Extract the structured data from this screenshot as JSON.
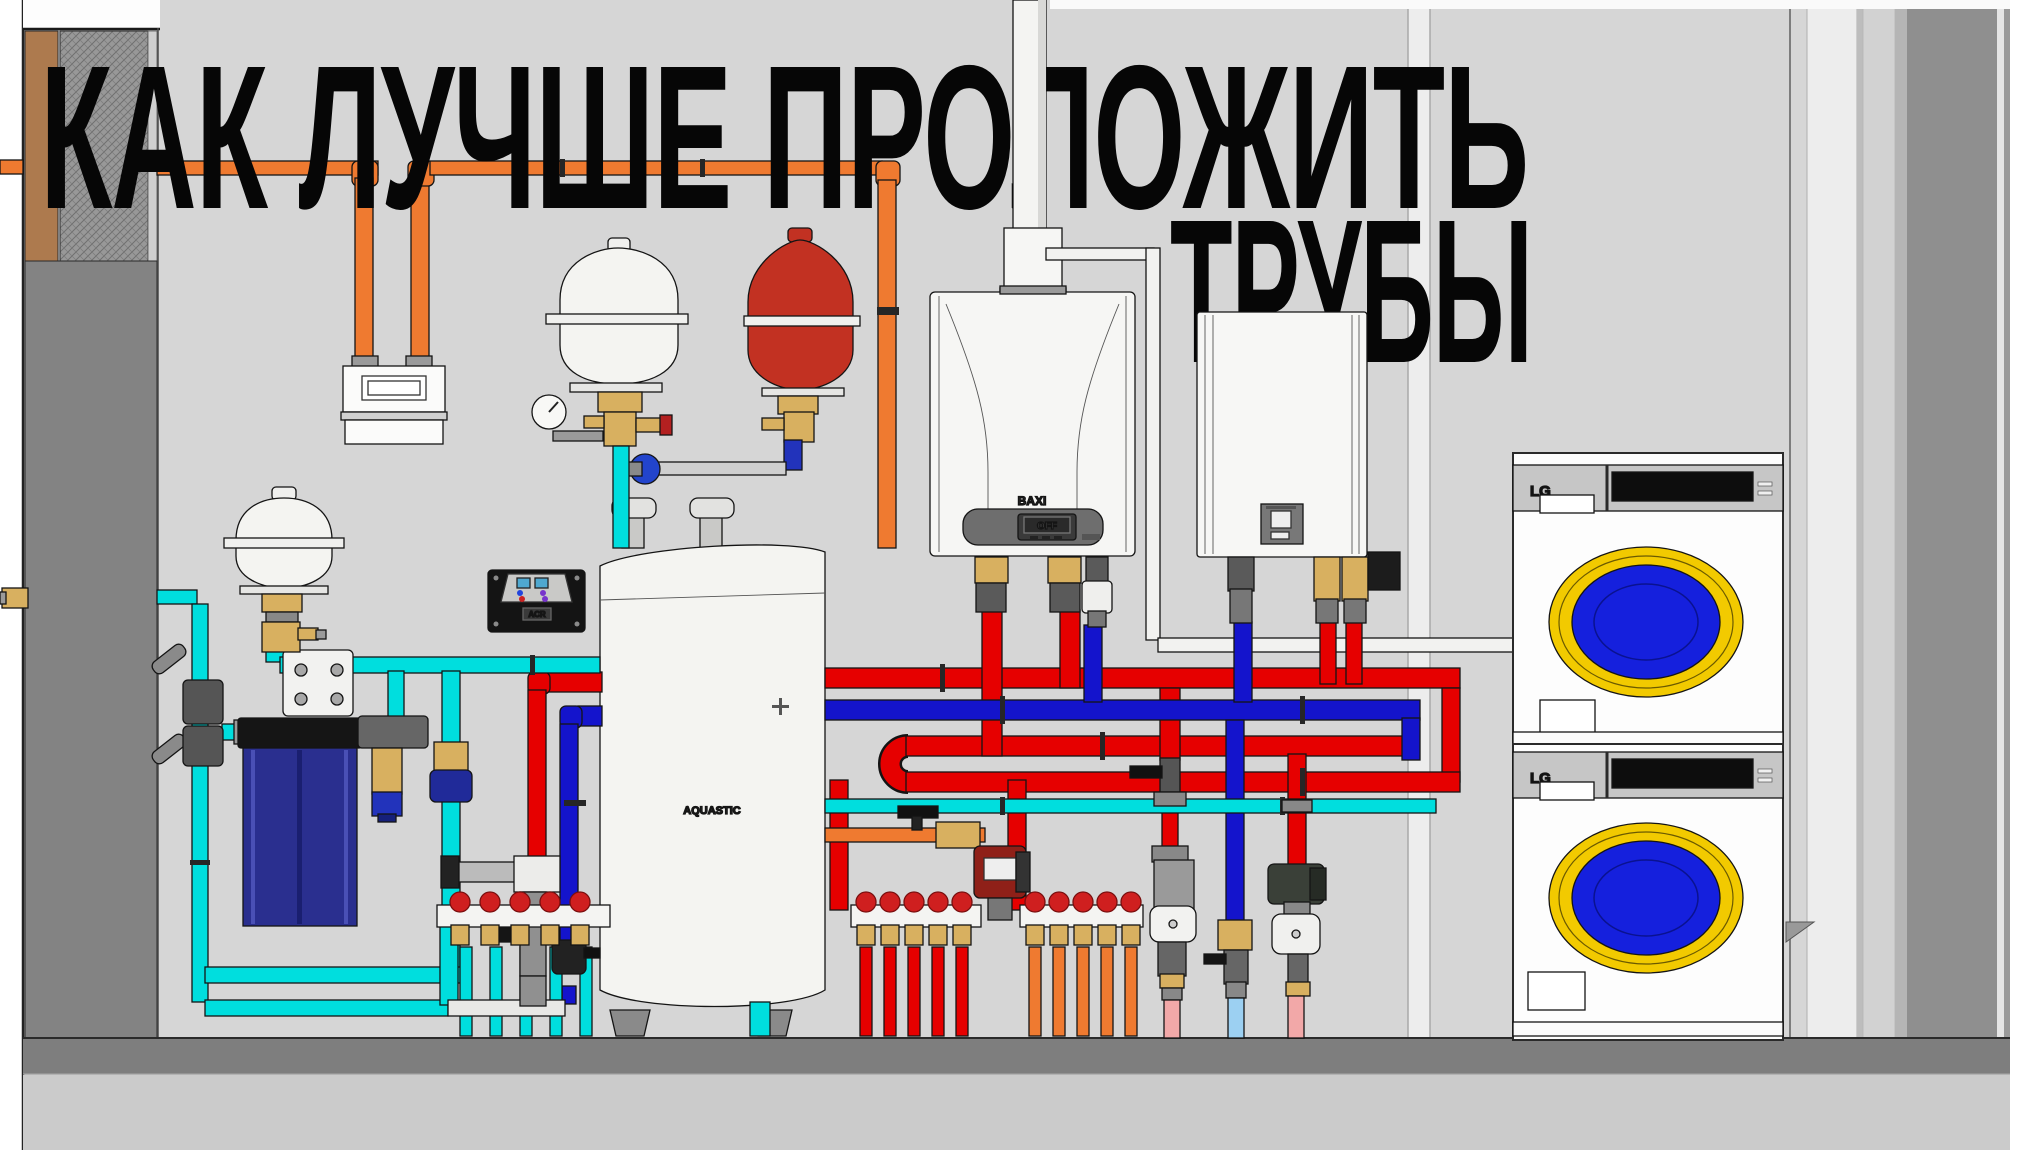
{
  "title": {
    "line1": "КАК  ЛУЧШЕ  ПРОЛОЖИТЬ",
    "line2": "ТРУБЫ"
  },
  "equipment": {
    "boiler": {
      "brand": "BAXI",
      "display": "OFF"
    },
    "buffer_tank": {
      "brand": "AQUASTIC"
    },
    "controller": {
      "label": "ACR"
    },
    "washer_top": {
      "brand": "LG"
    },
    "washer_bottom": {
      "brand": "LG"
    }
  },
  "colors": {
    "wall": "#d6d6d6",
    "floor_dark": "#7e7e7e",
    "floor_light": "#cbcbcb",
    "pipe_red": "#e60000",
    "pipe_blue": "#1414cc",
    "pipe_cyan": "#00dede",
    "pipe_orange": "#ef7a30",
    "pipe_pink": "#f2a8a8",
    "pipe_lightblue": "#9cd0f2",
    "brass": "#d8b060",
    "door_yellow": "#f2ca00",
    "door_blue": "#1520dd",
    "filter_blue": "#2a2f8f",
    "tank_red": "#c23122",
    "title_color": "#060606"
  }
}
